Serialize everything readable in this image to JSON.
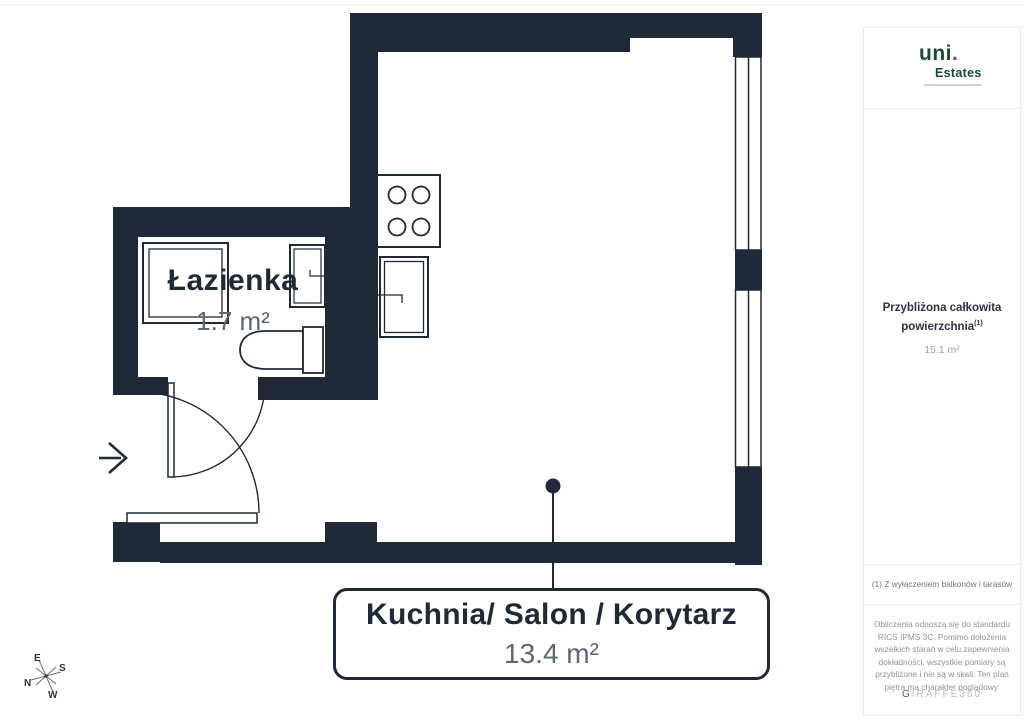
{
  "colors": {
    "wall_navy": "#1f2937",
    "area_gray": "#5d6675",
    "logo_green": "#1b4a33",
    "logo_dot_indigo": "#4f46c8",
    "sidebar_border": "#ebecee",
    "muted_gray": "#9aa1ab"
  },
  "floorplan": {
    "rooms": [
      {
        "name": "Łazienka",
        "area": "1.7 m²"
      },
      {
        "name": "Kuchnia/ Salon / Korytarz",
        "area": "13.4 m²"
      }
    ],
    "compass": {
      "n": "N",
      "e": "E",
      "s": "S",
      "w": "W"
    }
  },
  "sidebar": {
    "logo": {
      "brand": "uni",
      "brand_dot": ".",
      "sub": "Estates"
    },
    "total": {
      "label_line1": "Przybliżona całkowita",
      "label_line2": "powierzchnia",
      "superscript": "(1)",
      "value": "15.1 m²"
    },
    "footnote": "(1) Z wyłączeniem balkonów i tarasów",
    "disclaimer_lines": [
      "Obliczenia odnoszą się do standardu",
      "RICS IPMS 3C. Pomimo dołożenia",
      "wszelkich starań w celu zapewnienia",
      "dokładności, wszystkie pomiary są",
      "przybliżone i nie są w skali. Ten plan",
      "piętra ma charakter poglądowy."
    ],
    "watermark_first": "G",
    "watermark_rest": "IRAFFE360"
  }
}
